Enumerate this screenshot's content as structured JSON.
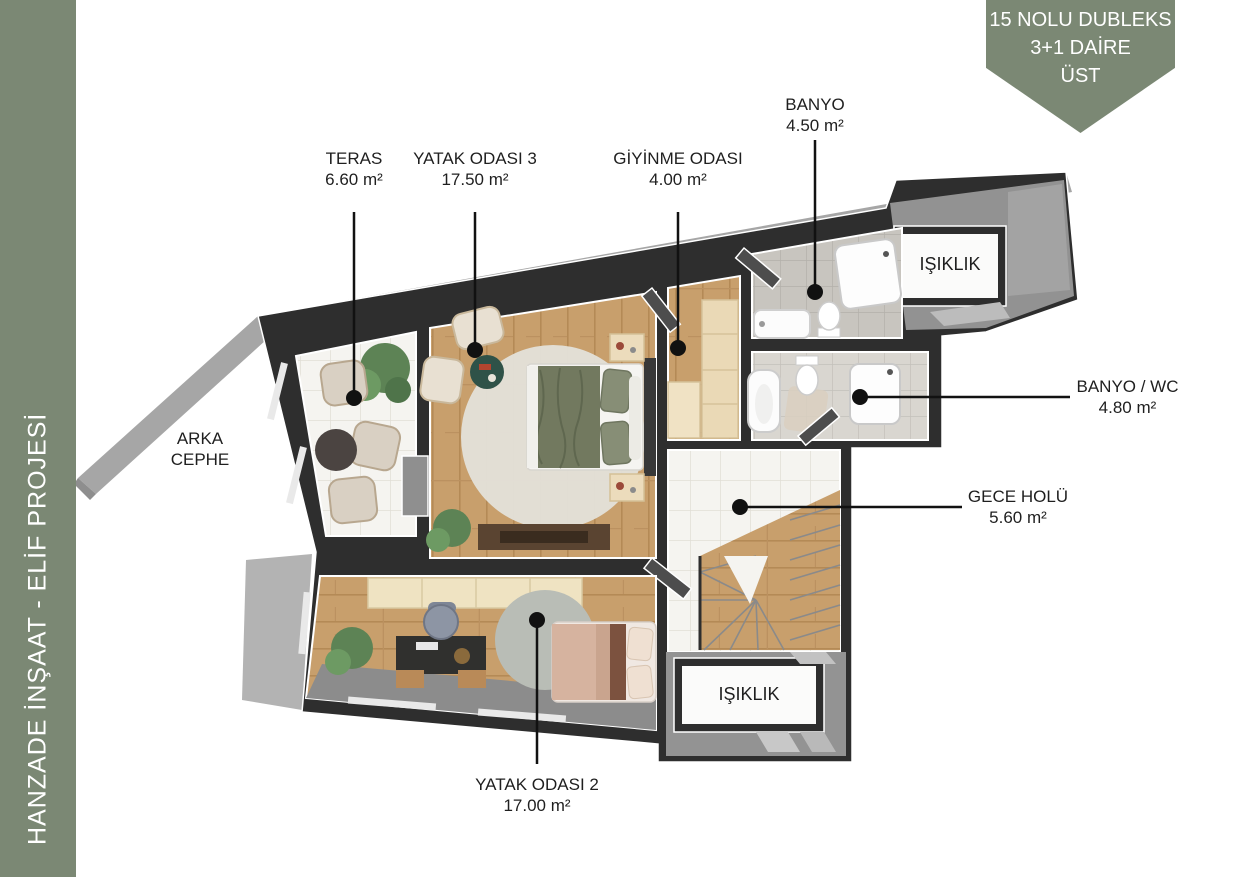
{
  "sidebar": {
    "text": "HANZADE İNŞAAT - ELİF PROJESİ",
    "color": "#7b8874"
  },
  "badge": {
    "line1": "15 NOLU DUBLEKS",
    "line2": "3+1 DAİRE",
    "line3": "ÜST",
    "color": "#7b8874"
  },
  "facade_label": {
    "line1": "ARKA",
    "line2": "CEPHE"
  },
  "shaft_label": "IŞIKLIK",
  "rooms": [
    {
      "id": "teras",
      "name": "TERAS",
      "area": "6.60 m²"
    },
    {
      "id": "yatak3",
      "name": "YATAK ODASI 3",
      "area": "17.50 m²"
    },
    {
      "id": "giyinme",
      "name": "GİYİNME ODASI",
      "area": "4.00 m²"
    },
    {
      "id": "banyo",
      "name": "BANYO",
      "area": "4.50 m²"
    },
    {
      "id": "banyo_wc",
      "name": "BANYO / WC",
      "area": "4.80 m²"
    },
    {
      "id": "gece",
      "name": "GECE HOLÜ",
      "area": "5.60 m²"
    },
    {
      "id": "yatak2",
      "name": "YATAK ODASI 2",
      "area": "17.00 m²"
    }
  ],
  "colors": {
    "accent_green": "#7b8874",
    "wall_dark": "#2e2e2e",
    "wood_floor": "#c89f6c",
    "white_tile": "#f5f4f0",
    "bath_tile": "#c8c5bf",
    "eave_gray": "#a6a6a6",
    "label_text": "#1f1f1f"
  }
}
